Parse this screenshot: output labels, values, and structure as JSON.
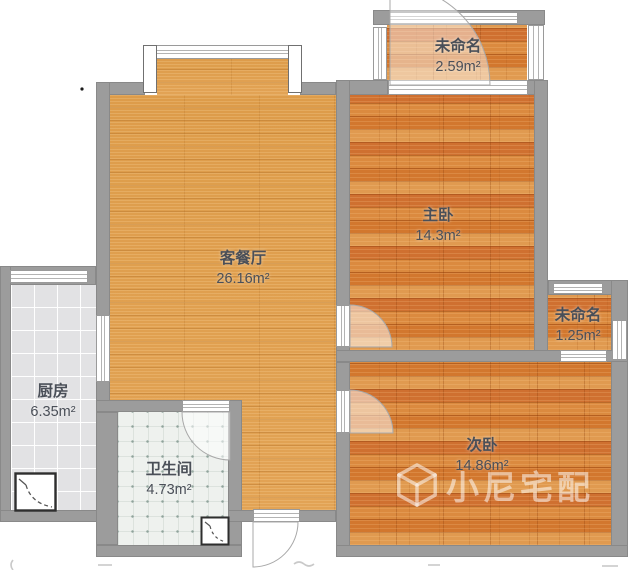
{
  "plan": {
    "title": "apartment-floorplan",
    "rooms": [
      {
        "name": "客餐厅",
        "area": "26.16m²"
      },
      {
        "name": "主卧",
        "area": "14.3m²"
      },
      {
        "name": "次卧",
        "area": "14.86m²"
      },
      {
        "name": "厨房",
        "area": "6.35m²"
      },
      {
        "name": "卫生间",
        "area": "4.73m²"
      },
      {
        "name": "未命名",
        "area": "2.59m²"
      },
      {
        "name": "未命名",
        "area": "1.25m²"
      }
    ],
    "watermark": {
      "text": "小尼宅配",
      "icon": "cube-logo-icon"
    },
    "colors": {
      "wall": "#9c9c9c",
      "living_floor": "#e2a355",
      "plank_floor": "#d8813a",
      "kitchen_floor": "#e3e3e5",
      "bath_floor": "#eef1ee",
      "label": "#4a4f58",
      "watermark": "rgba(255,255,255,0.52)"
    }
  }
}
